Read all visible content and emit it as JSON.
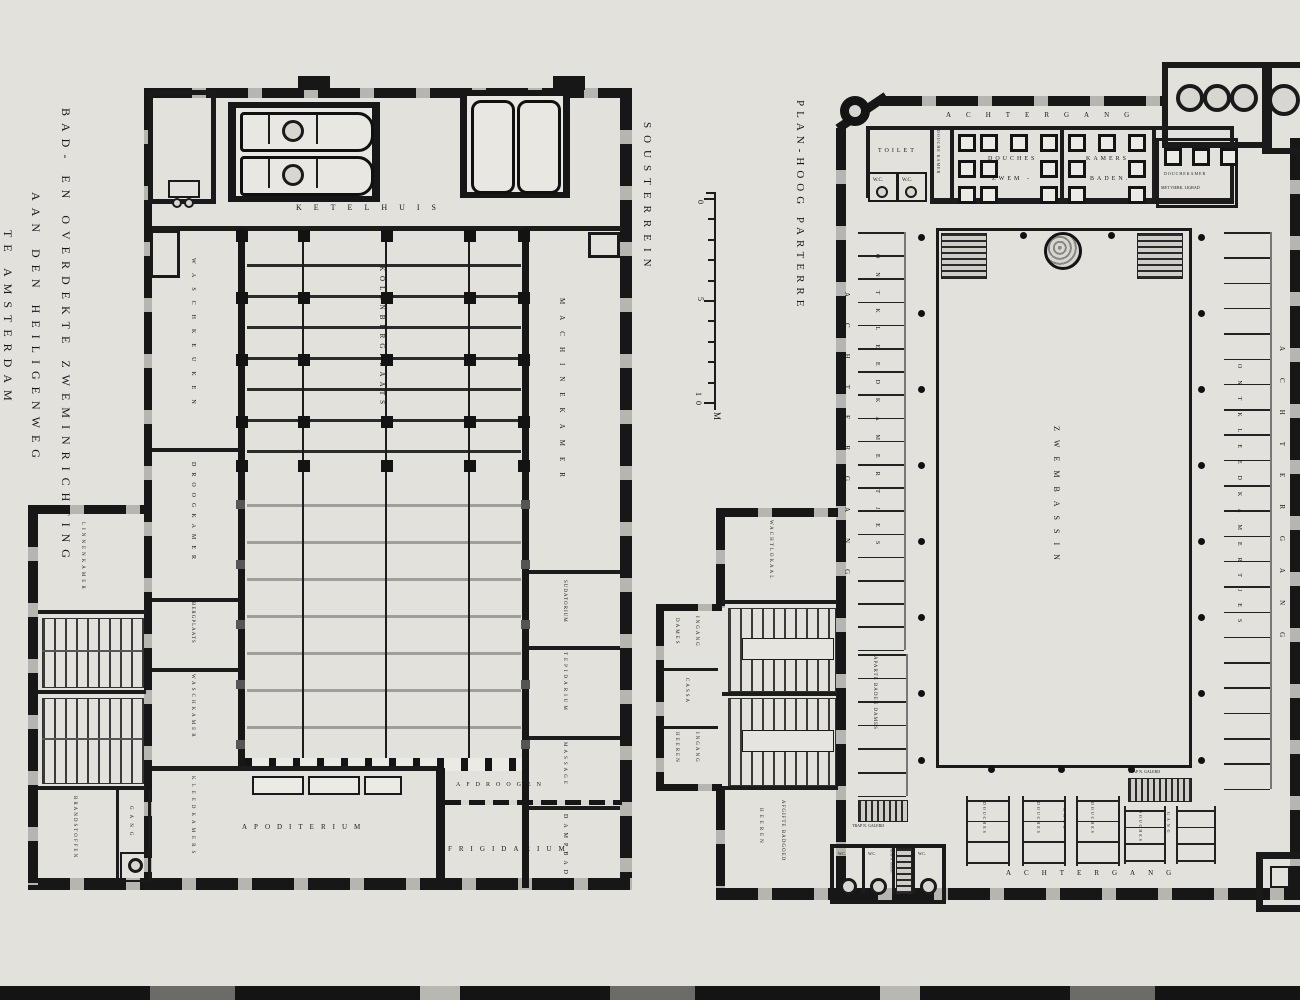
{
  "title": {
    "line1": "BAD- EN OVERDEKTE ZWEMINRICHTING",
    "line2": "AAN DEN HEILIGENWEG",
    "line3": "TE AMSTERDAM"
  },
  "scale": {
    "t0": "0",
    "t5": "5",
    "t10": "10",
    "unit": "M"
  },
  "left_plan": {
    "name": "SOUSTERREIN",
    "rooms": {
      "ketelhuis": "KETELHUIS",
      "kolenbergplaats": "KOLENBERGPLAATS",
      "waschkeuken": "WASCHKEUKEN",
      "droogkamer": "DROOGKAMER",
      "bergplaats": "BERGPLAATS",
      "waschkamer": "WASCHKAMER",
      "machinekamer": "MACHINEKAMER",
      "sudatorium": "SUDATORIUM",
      "tepidarium": "TEPIDARIUM",
      "massage": "MASSAGE",
      "dampbad": "DAMPBAD",
      "apoditerium": "APODITERIUM",
      "afdroogen": "AFDROOGEN",
      "frigidarium": "FRIGIDARIUM",
      "linnenkamer": "LINNENKAMER",
      "brandstoffen": "BRANDSTOFFEN",
      "gang": "GANG",
      "kleedkamers": "KLEEDKAMERS"
    }
  },
  "right_plan": {
    "name": "PLAN-HOOG PARTERRE",
    "rooms": {
      "achtergang": "ACHTERGANG",
      "toilet": "TOILET",
      "wc": "W.C.",
      "douchekamer_narrow": "DOUCHE KAMER",
      "douches_zwem_1": "DOUCHES",
      "douches_zwem_2": "ZWEM -",
      "kamers_1": "KAMERS",
      "kamers_2": "BADEN.",
      "ligbad_1": "DOUCHEKAMER",
      "ligbad_2": "MET VIERK. LIGBAD",
      "ontkleedkamertjes": "ONTKLEEDKAMERTJES",
      "aparte_baden": "APARTE BADEN DAMES",
      "zwembassin": "ZWEMBASSIN",
      "douches": "DOUCHES",
      "gang": "GANG",
      "trap_galerij": "TRAP N. GALERIJ",
      "trap_soust": "TRAP N. SOUST.",
      "wachtlokaal": "WACHTLOKAAL",
      "dames": "DAMES",
      "ingang": "INGANG",
      "cassa": "CASSA",
      "heeren": "HEEREN",
      "afgifte": "AFGIFTE BADGOED"
    }
  }
}
